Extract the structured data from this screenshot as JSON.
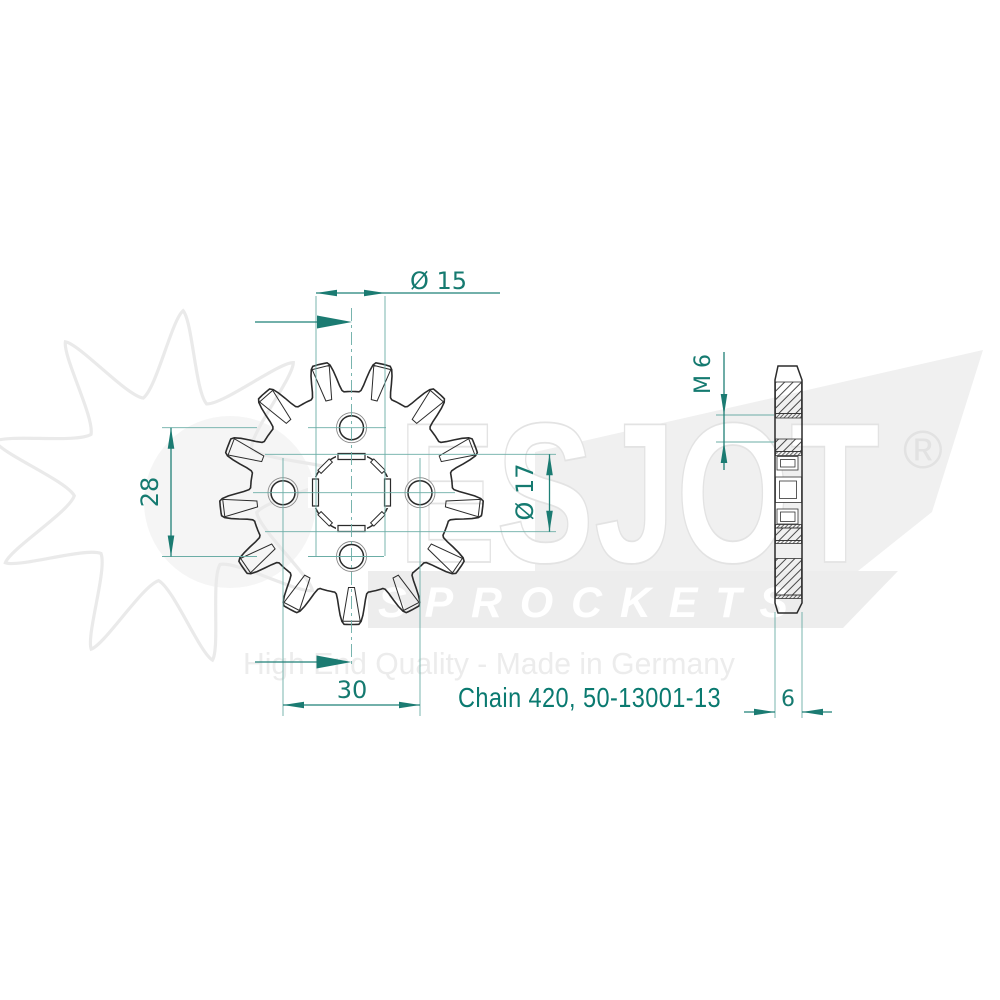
{
  "watermark": {
    "brand": "ESJOT",
    "registered_symbol": "®",
    "band_text": "SPROCKETS",
    "tagline": "High End Quality - Made in Germany"
  },
  "front_view": {
    "teeth": 13,
    "bolt_holes": 4
  },
  "dims": {
    "phi15": "Ø 15",
    "pitch28": "28",
    "pitch30": "30",
    "phi17": "Ø 17",
    "m6": "M 6",
    "width6": "6"
  },
  "part_label": "Chain 420, 50-13001-13",
  "colors": {
    "dimension_line": "#1f8077",
    "centerline": "#6bada6",
    "dimension_text": "#157a70",
    "arrow_fill": "#1b7b72",
    "label_text": "#0a7a70",
    "drawing_line": "#2b2b2b",
    "watermark_gray": "#ececec"
  }
}
